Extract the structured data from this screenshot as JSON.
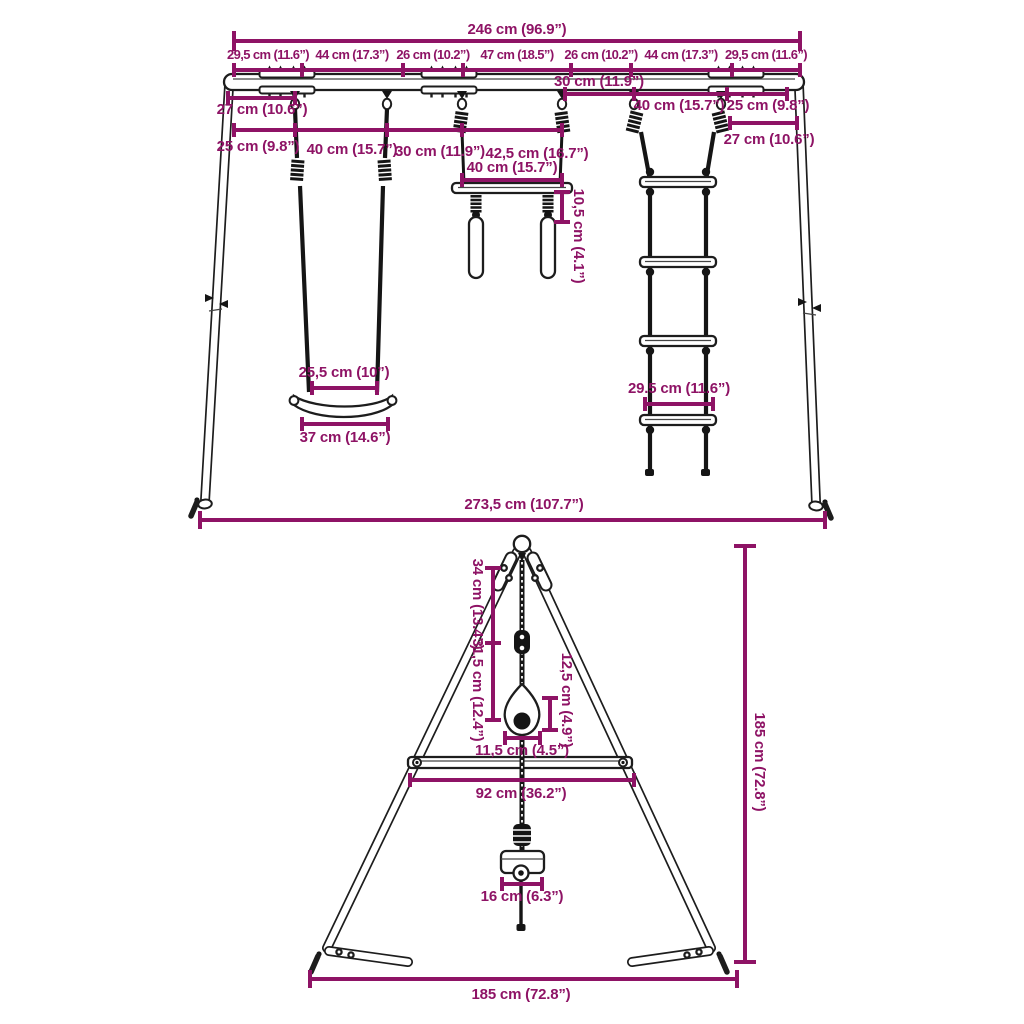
{
  "diagram": {
    "dim_color": "#8e1365",
    "front_view": {
      "total_top": "246 cm (96.9”)",
      "segments": [
        "29,5 cm (11.6”)",
        "44 cm (17.3”)",
        "26 cm (10.2”)",
        "47 cm (18.5”)",
        "26 cm (10.2”)",
        "44 cm (17.3”)",
        "29,5 cm (11.6”)"
      ],
      "left_offset_27": "27 cm (10.6”)",
      "row2_25": "25 cm (9.8”)",
      "row2_40": "40 cm (15.7”)",
      "row2_30": "30 cm (11.9”)",
      "row2_42_5": "42,5 cm (16.7”)",
      "right_30": "30 cm (11.9”)",
      "right_40": "40 cm (15.7”)",
      "right_25": "25 cm (9.8”)",
      "right_27": "27 cm (10.6”)",
      "trapeze_40": "40 cm (15.7”)",
      "trapeze_10_5": "10,5 cm (4.1”)",
      "swing_25_5": "25,5 cm (10”)",
      "swing_37": "37 cm (14.6”)",
      "ladder_29_5": "29.5 cm (11.6”)",
      "total_bottom": "273,5 cm (107.7”)"
    },
    "side_view": {
      "rope_34": "34 cm (13.4”)",
      "rope_31_5": "31,5 cm (12.4”)",
      "handle_12_5": "12,5 cm (4.9”)",
      "handle_11_5": "11,5 cm (4.5”)",
      "crossbar_92": "92 cm (36.2”)",
      "height_185": "185 cm (72.8”)",
      "seat_16": "16 cm (6.3”)",
      "depth_185": "185 cm (72.8”)"
    }
  }
}
